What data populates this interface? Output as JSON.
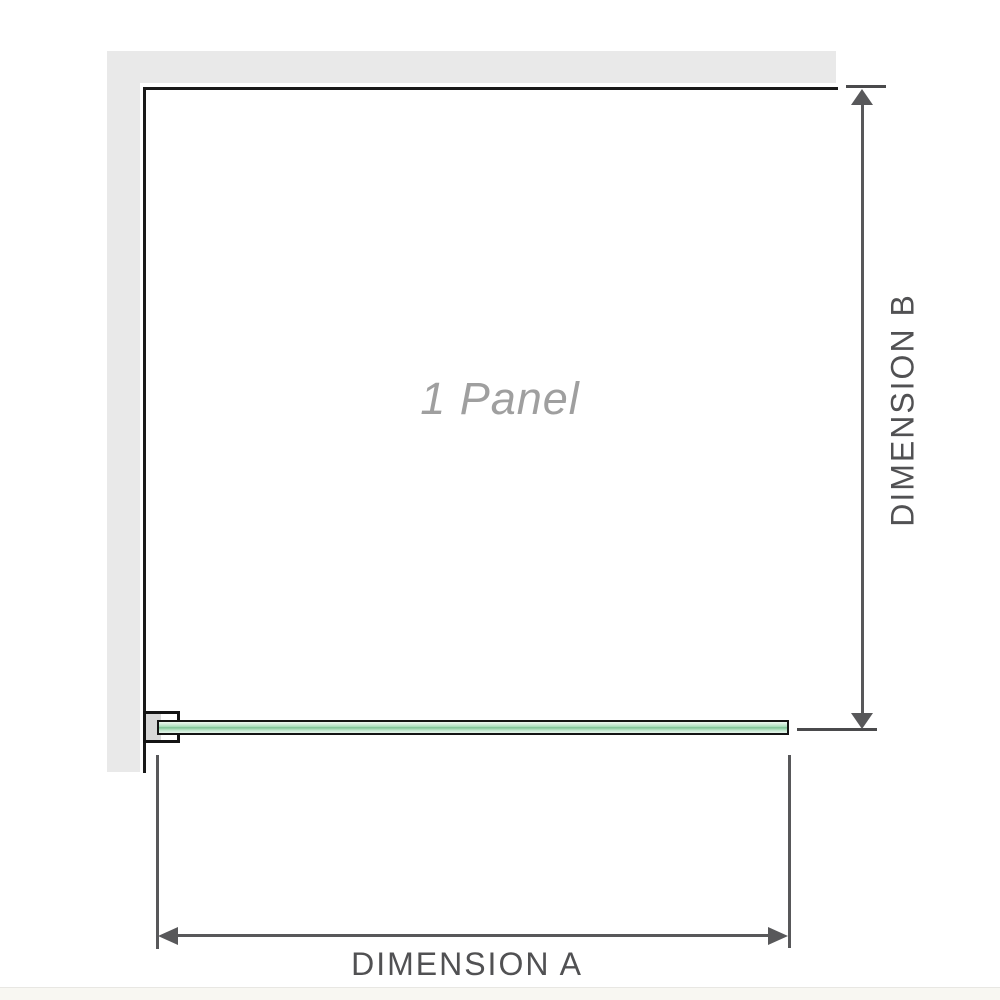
{
  "diagram": {
    "title_watermark": "1 Panel",
    "type": "shower-screen single fixed panel, plan/elevation dimension drawing"
  },
  "labels": {
    "panel": "1 Panel",
    "dimension_a": "DIMENSION A",
    "dimension_b": "DIMENSION B"
  },
  "colors": {
    "background": "#ffffff",
    "wall_fill": "#e9e9e9",
    "panel_border": "#1a1a1a",
    "glass_green_light": "#cdebd7",
    "glass_green_mid": "#a9debb",
    "glass_green_dark": "#7bbf93",
    "bracket_pad_fill": "#d8d8d8",
    "dimension_line": "#58585a",
    "dimension_text": "#515153",
    "watermark_text": "#9f9f9f",
    "bottom_band": "#f8f7f2"
  }
}
